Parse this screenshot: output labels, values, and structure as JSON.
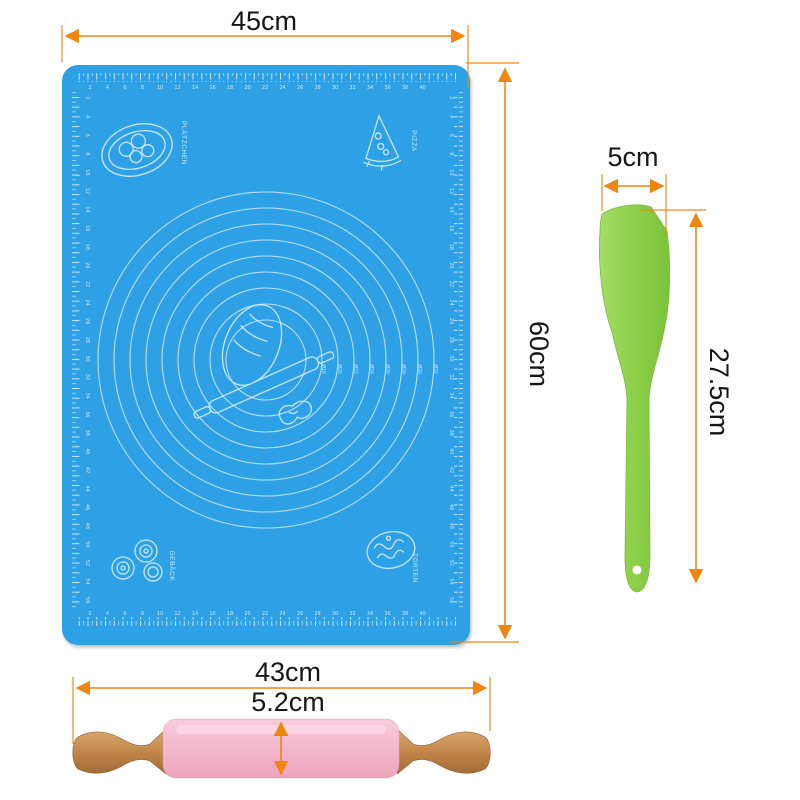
{
  "colors": {
    "background": "#ffffff",
    "dimension_line": "#F0850F",
    "label_text": "#161616",
    "mat_blue": "#2FA1E6",
    "mat_print": "#D9EEFB",
    "spatula_green": "#8CCF49",
    "pin_pink": "#F3B6CA",
    "wood_tan": "#C08449"
  },
  "dimensions": {
    "mat_width": "45cm",
    "mat_height": "60cm",
    "spatula_width": "5cm",
    "spatula_length": "27.5cm",
    "pin_length": "43cm",
    "pin_diameter": "5.2cm"
  },
  "mat": {
    "corner_labels": {
      "top_left": "PLÄTZCHEN",
      "top_right": "PIZZA",
      "bottom_left": "GEBÄCK",
      "bottom_right": "TORTEN"
    },
    "circle_labels": [
      "Ø18",
      "Ø20",
      "Ø22",
      "Ø24",
      "Ø26",
      "Ø28",
      "Ø30",
      "Ø32"
    ],
    "circle_count": 9,
    "ruler_numbers_horizontal": [
      "2",
      "4",
      "6",
      "8",
      "10",
      "12",
      "14",
      "16",
      "18",
      "20",
      "22",
      "24",
      "26",
      "28",
      "30",
      "32",
      "34",
      "36",
      "38",
      "40"
    ],
    "ruler_numbers_vertical": [
      "2",
      "4",
      "6",
      "8",
      "10",
      "12",
      "14",
      "16",
      "18",
      "20",
      "22",
      "24",
      "26",
      "28",
      "30",
      "32",
      "34",
      "36",
      "38",
      "40",
      "42",
      "44",
      "46",
      "48",
      "50",
      "52",
      "54",
      "56"
    ]
  }
}
